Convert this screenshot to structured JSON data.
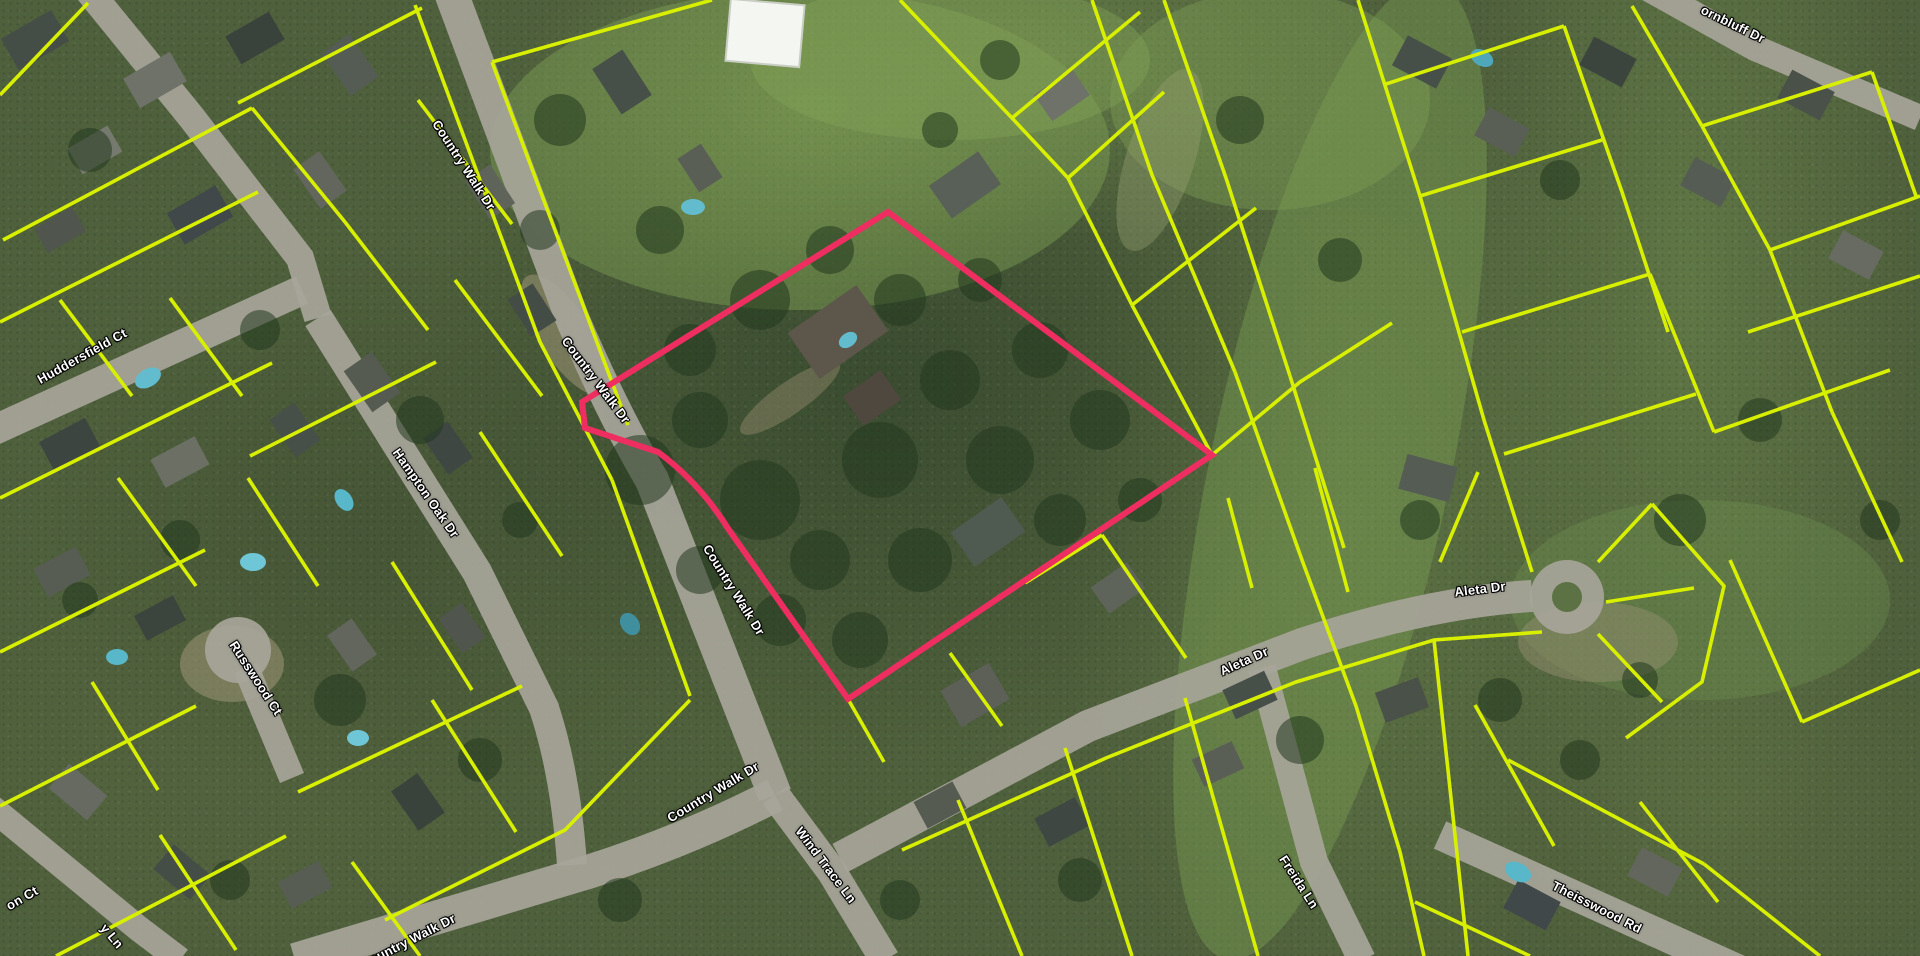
{
  "map": {
    "type": "satellite-parcel-map",
    "description": "Aerial imagery with parcel boundary overlay and one highlighted parcel"
  },
  "colors": {
    "parcel_boundary": "#d8f000",
    "highlighted_parcel": "#ee2e61",
    "road": "#a7a59a",
    "street_label_text": "#ffffff",
    "street_label_outline": "#000000"
  },
  "street_labels": [
    {
      "name": "country-walk-dr-north",
      "text": "Country Walk Dr"
    },
    {
      "name": "country-walk-dr-upper-mid",
      "text": "Country Walk Dr"
    },
    {
      "name": "country-walk-dr-lower-mid",
      "text": "Country Walk Dr"
    },
    {
      "name": "country-walk-dr-bend",
      "text": "Country Walk Dr"
    },
    {
      "name": "country-walk-dr-south",
      "text": "Country Walk Dr"
    },
    {
      "name": "huddersfield-ct",
      "text": "Huddersfield Ct"
    },
    {
      "name": "hampton-oak-dr",
      "text": "Hampton Oak Dr"
    },
    {
      "name": "russwood-ct",
      "text": "Russwood Ct"
    },
    {
      "name": "wind-trace-ln",
      "text": "Wind Trace Ln"
    },
    {
      "name": "aleta-dr-west",
      "text": "Aleta Dr"
    },
    {
      "name": "aleta-dr-east",
      "text": "Aleta Dr"
    },
    {
      "name": "freida-ln",
      "text": "Freida Ln"
    },
    {
      "name": "theisswood-rd",
      "text": "Theisswood Rd"
    },
    {
      "name": "ornbluff-dr-partial",
      "text": "ornbluff Dr"
    },
    {
      "name": "y-ln-partial",
      "text": "y Ln"
    },
    {
      "name": "on-ct-partial",
      "text": "on Ct"
    }
  ]
}
